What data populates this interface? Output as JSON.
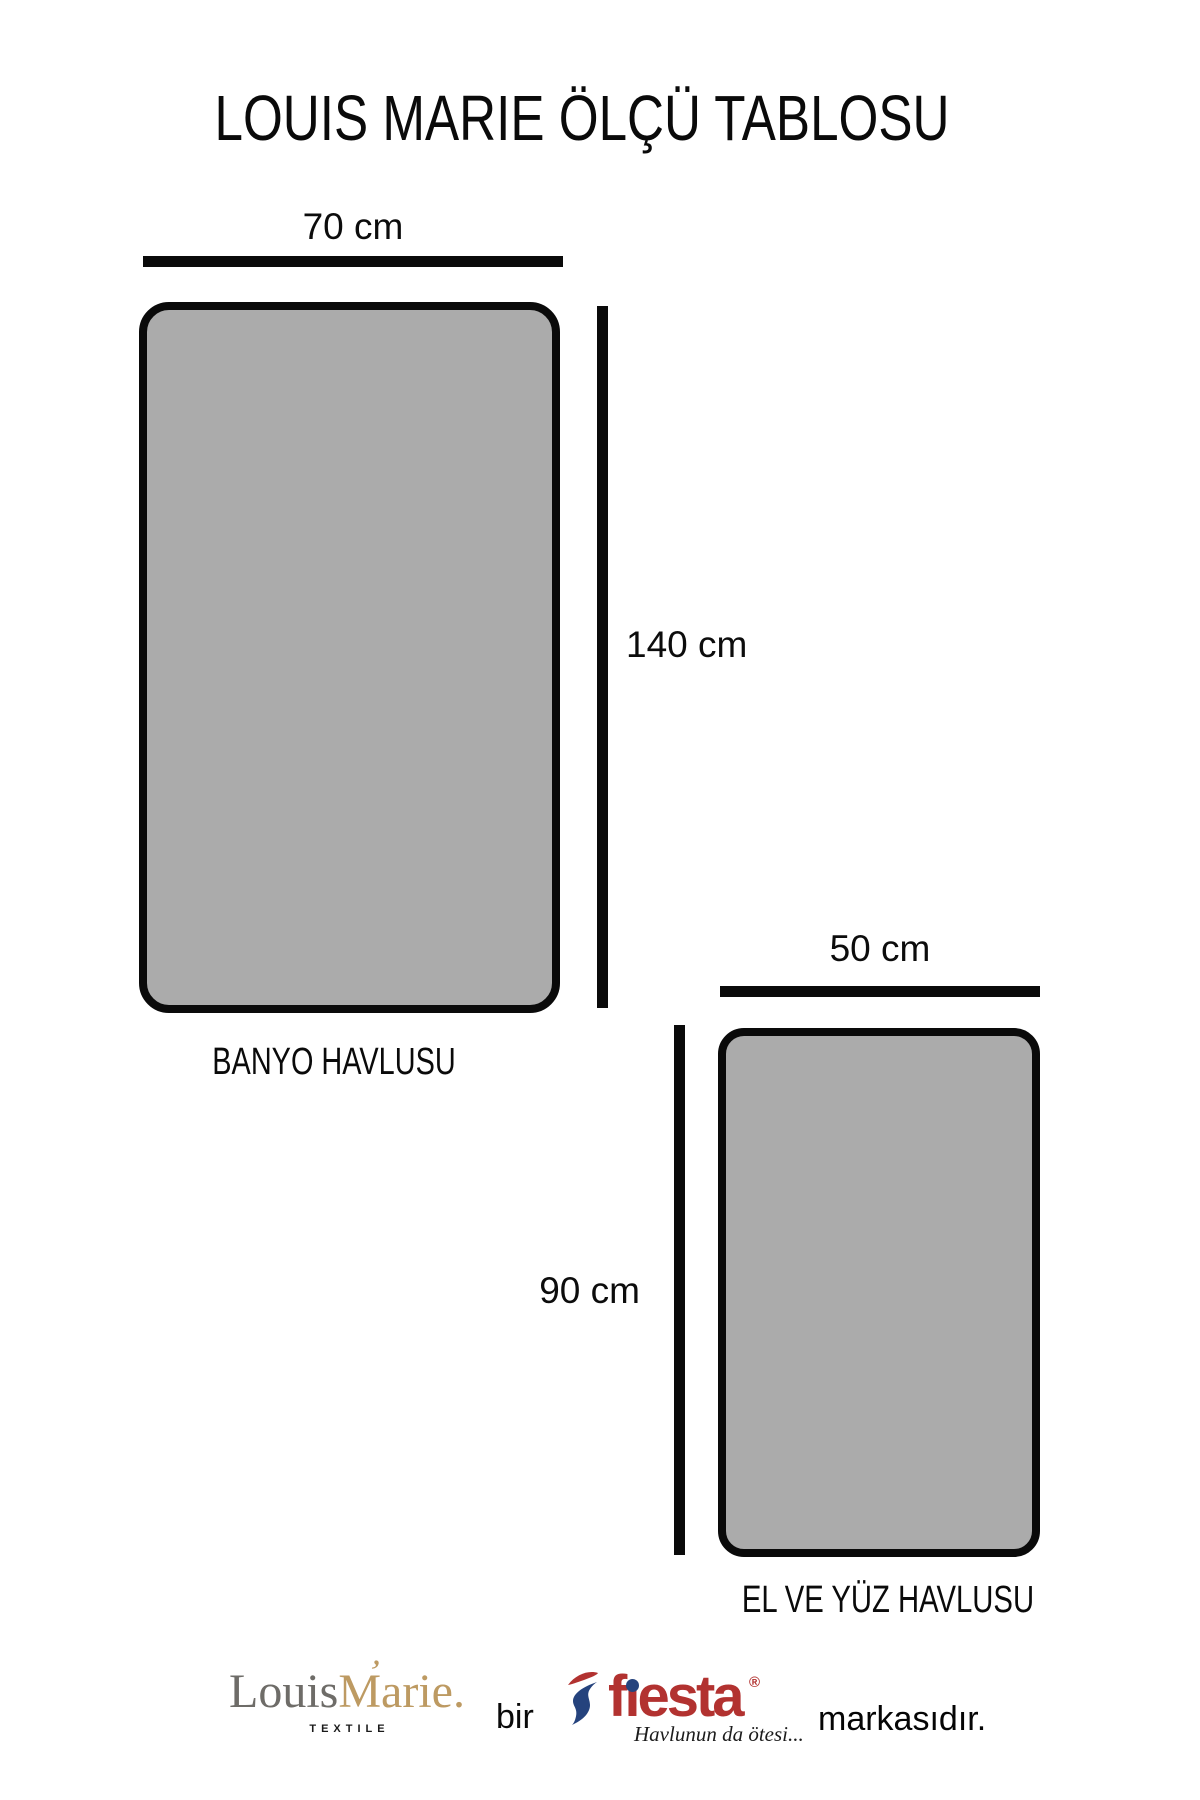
{
  "title": "LOUIS MARIE ÖLÇÜ TABLOSU",
  "towels": [
    {
      "name": "BANYO HAVLUSU",
      "width_label": "70 cm",
      "height_label": "140 cm",
      "width_cm": 70,
      "height_cm": 140
    },
    {
      "name": "EL VE YÜZ HAVLUSU",
      "width_label": "50 cm",
      "height_label": "90 cm",
      "width_cm": 50,
      "height_cm": 90
    }
  ],
  "footer": {
    "brand_first": "Louis",
    "brand_swash": "’",
    "brand_second": "Marie.",
    "brand_sub": "TEXTILE",
    "bir": "bir",
    "fiesta": {
      "pre": "f",
      "dotless_i": "ı",
      "post": "esta",
      "reg": "®",
      "tagline": "Havlunun da ötesi..."
    },
    "markasidir": "markasıdır."
  },
  "colors": {
    "towel_fill": "#ababab",
    "outline": "#0a0a0a",
    "brand_gray": "#6e6c68",
    "brand_gold": "#bd9a62",
    "fiesta_red": "#b23230",
    "fiesta_blue": "#25437d"
  }
}
